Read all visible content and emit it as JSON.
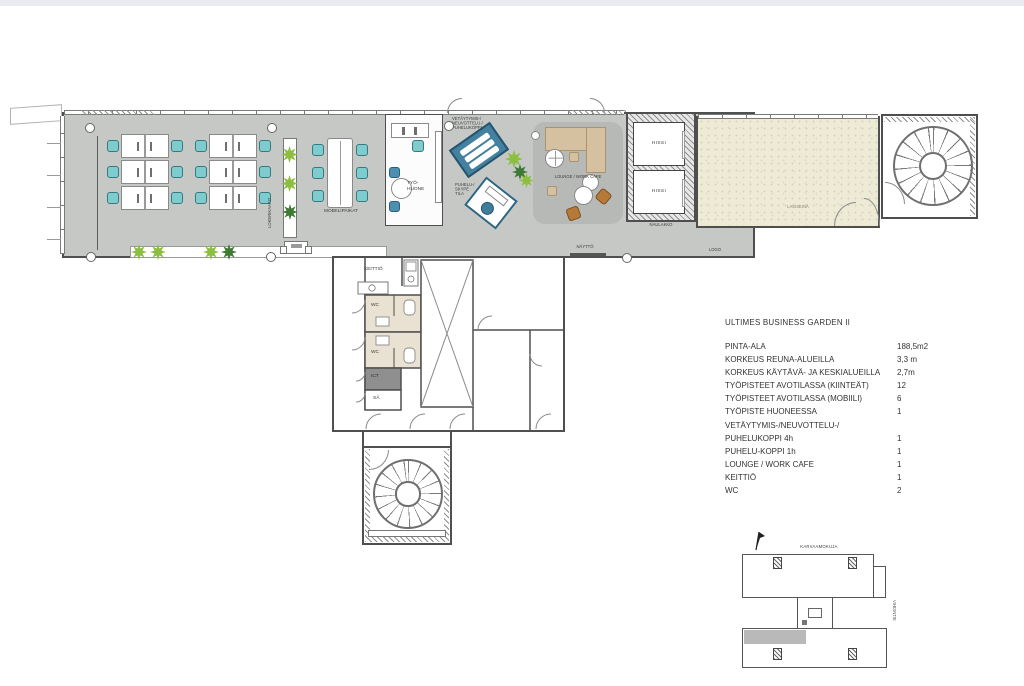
{
  "plan": {
    "open_office": {
      "lokerikaapit": "LOKERIKAAPIT",
      "mobiilipaikat": "MOBIILIPAIKAT"
    },
    "rooms": {
      "tyohuone": "TYÖ-\nHUONE",
      "vetaytymis_booth": "VETÄYTYMIS-/\nNEUVOTTELU-/\nPUHELUKOPPI",
      "puhelu_booth": "PUHELU-/\nSKYPE\nTILA",
      "lounge": "LOUNGE / WORK CAFE",
      "hissi_1": "HISSI",
      "hissi_2": "HISSI",
      "naulakko": "NAULAKKO",
      "lasiseina": "LASISEINÄ",
      "naytto": "NÄYTTÖ",
      "logo": "LOGO",
      "keittio": "KEITTIÖ",
      "wc_1": "WC",
      "wc_2": "WC",
      "ict": "ICT",
      "sa": "SÄ"
    }
  },
  "spec_table": {
    "title": "ULTIMES BUSINESS GARDEN II",
    "rows": [
      {
        "label": "PINTA-ALA",
        "value": "188,5m2"
      },
      {
        "label": "KORKEUS REUNA-ALUEILLA",
        "value": "3,3 m"
      },
      {
        "label": "KORKEUS KÄYTÄVÄ- JA KESKIALUEILLA",
        "value": "2,7m"
      },
      {
        "label": "TYÖPISTEET AVOTILASSA (KIINTEÄT)",
        "value": "12"
      },
      {
        "label": "TYÖPISTEET AVOTILASSA (MOBIILI)",
        "value": "6"
      },
      {
        "label": "TYÖPISTE HUONEESSA",
        "value": "1"
      },
      {
        "label": "VETÄYTYMIS-/NEUVOTTELU-/",
        "value": ""
      },
      {
        "label": "PUHELUKOPPI 4h",
        "value": "1"
      },
      {
        "label": "PUHELU-KOPPI 1h",
        "value": "1"
      },
      {
        "label": "LOUNGE / WORK CAFE",
        "value": "1"
      },
      {
        "label": "KEITTIÖ",
        "value": "1"
      },
      {
        "label": "WC",
        "value": "2"
      }
    ]
  },
  "site_plan": {
    "street_top": "KARVAAMOKUJA",
    "street_right": "VIHDINTIE"
  },
  "colors": {
    "floor": "#c6c8c6",
    "lounge_floor": "#b6b9b6",
    "wall": "#4f4f4f",
    "chair_teal": "#7fccce",
    "booth_blue": "#44809f",
    "sofa_beige": "#d5c1a0",
    "chair_brown": "#b5793a",
    "terrace_beige": "#edead6",
    "wc_beige": "#e9e1d1",
    "ict_gray": "#8f8f8f",
    "plant_light": "#8cbf3f",
    "plant_dark": "#3e7a33",
    "location_highlight": "#b9b9b9"
  }
}
